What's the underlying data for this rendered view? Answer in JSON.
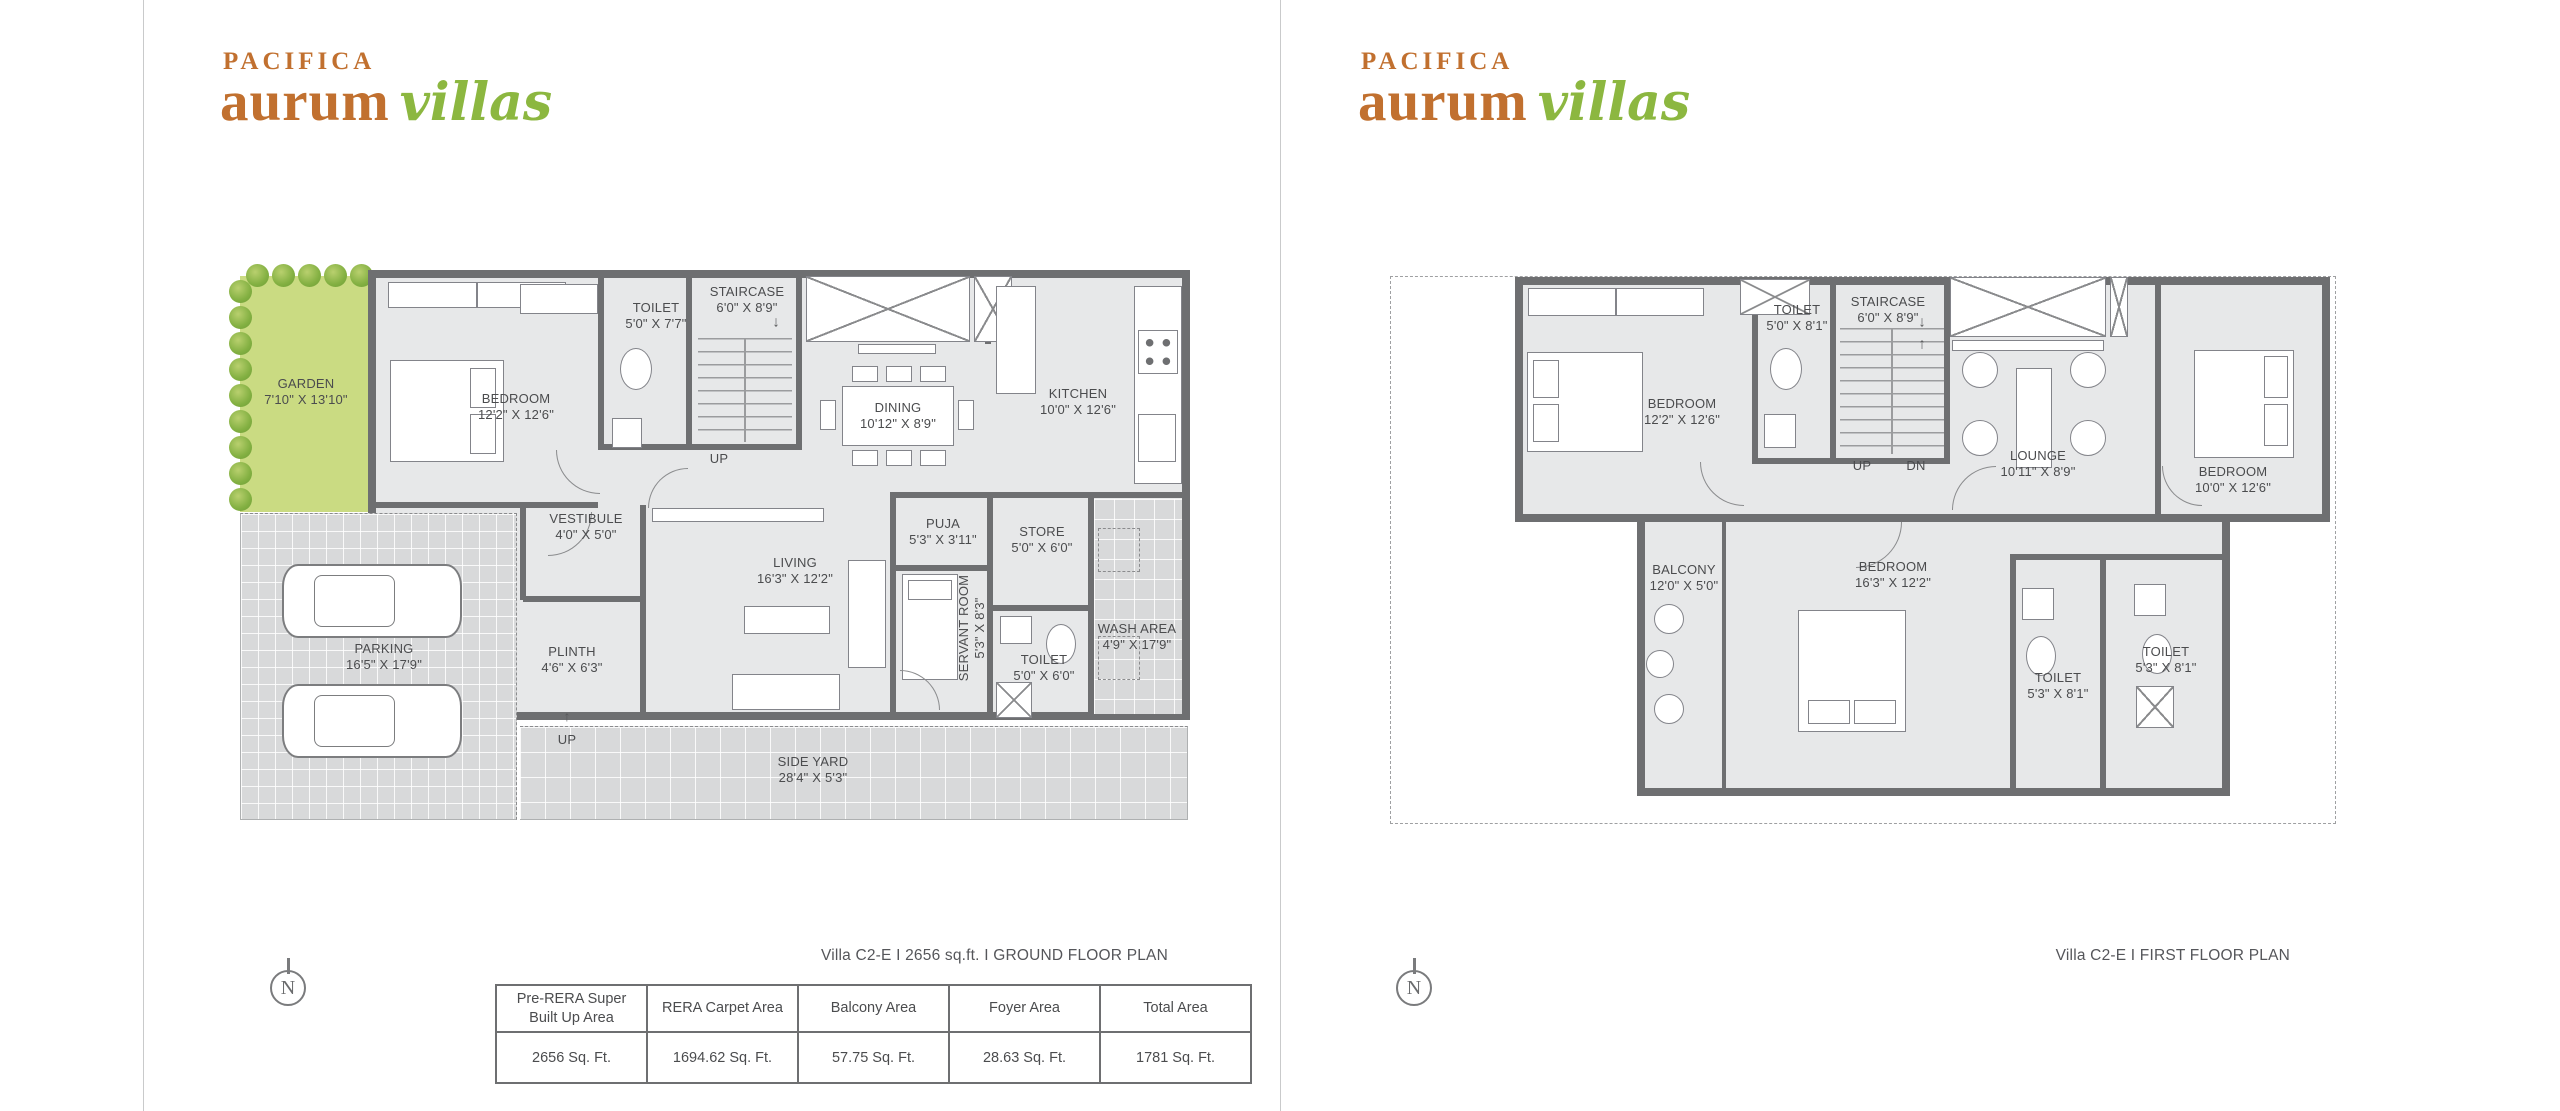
{
  "brand": {
    "line1": "PACIFICA",
    "line2": "aurum",
    "line3": "villas"
  },
  "colors": {
    "brand_orange": "#c1702f",
    "brand_green": "#8cb740",
    "wall_gray": "#6e6f71",
    "room_fill": "#e7e8e9",
    "garden_green": "#cadb82",
    "paving_gray": "#d8d9da"
  },
  "compass_label": "N",
  "ground_floor": {
    "caption": "Villa C2-E I 2656 sq.ft. I GROUND FLOOR PLAN",
    "stair_up_label": "UP",
    "entry_up_label": "UP",
    "stair_down_arrow": "↓",
    "entry_up_arrow": "↑",
    "rooms": [
      {
        "name": "GARDEN",
        "dims": "7'10\" X 13'10\""
      },
      {
        "name": "BEDROOM",
        "dims": "12'2\" X 12'6\""
      },
      {
        "name": "TOILET",
        "dims": "5'0\" X 7'7\""
      },
      {
        "name": "STAIRCASE",
        "dims": "6'0\" X 8'9\""
      },
      {
        "name": "DINING",
        "dims": "10'12\" X 8'9\""
      },
      {
        "name": "KITCHEN",
        "dims": "10'0\" X 12'6\""
      },
      {
        "name": "VESTIBULE",
        "dims": "4'0\" X 5'0\""
      },
      {
        "name": "LIVING",
        "dims": "16'3\" X 12'2\""
      },
      {
        "name": "PUJA",
        "dims": "5'3\" X 3'11\""
      },
      {
        "name": "STORE",
        "dims": "5'0\" X 6'0\""
      },
      {
        "name": "SERVANT ROOM",
        "dims": "5'3\" X 8'3\""
      },
      {
        "name": "TOILET",
        "dims": "5'0\" X 6'0\""
      },
      {
        "name": "WASH AREA",
        "dims": "4'9\" X 17'9\""
      },
      {
        "name": "PARKING",
        "dims": "16'5\" X 17'9\""
      },
      {
        "name": "PLINTH",
        "dims": "4'6\" X 6'3\""
      },
      {
        "name": "SIDE YARD",
        "dims": "28'4\" X 5'3\""
      }
    ]
  },
  "first_floor": {
    "caption": "Villa C2-E I FIRST FLOOR PLAN",
    "stair_up_label": "UP",
    "stair_dn_label": "DN",
    "stair_down_arrow": "↓",
    "stair_up_arrow": "↑",
    "rooms": [
      {
        "name": "BEDROOM",
        "dims": "12'2\" X 12'6\""
      },
      {
        "name": "TOILET",
        "dims": "5'0\" X 8'1\""
      },
      {
        "name": "STAIRCASE",
        "dims": "6'0\" X 8'9\""
      },
      {
        "name": "LOUNGE",
        "dims": "10'11\" X 8'9\""
      },
      {
        "name": "BEDROOM",
        "dims": "10'0\" X 12'6\""
      },
      {
        "name": "BALCONY",
        "dims": "12'0\" X 5'0\""
      },
      {
        "name": "BEDROOM",
        "dims": "16'3\" X 12'2\""
      },
      {
        "name": "TOILET",
        "dims": "5'3\" X 8'1\""
      },
      {
        "name": "TOILET",
        "dims": "5'3\" X 8'1\""
      }
    ]
  },
  "area_table": {
    "headers": [
      "Pre-RERA Super Built Up Area",
      "RERA Carpet Area",
      "Balcony Area",
      "Foyer Area",
      "Total Area"
    ],
    "values": [
      "2656 Sq. Ft.",
      "1694.62 Sq. Ft.",
      "57.75 Sq. Ft.",
      "28.63 Sq. Ft.",
      "1781 Sq. Ft."
    ]
  }
}
